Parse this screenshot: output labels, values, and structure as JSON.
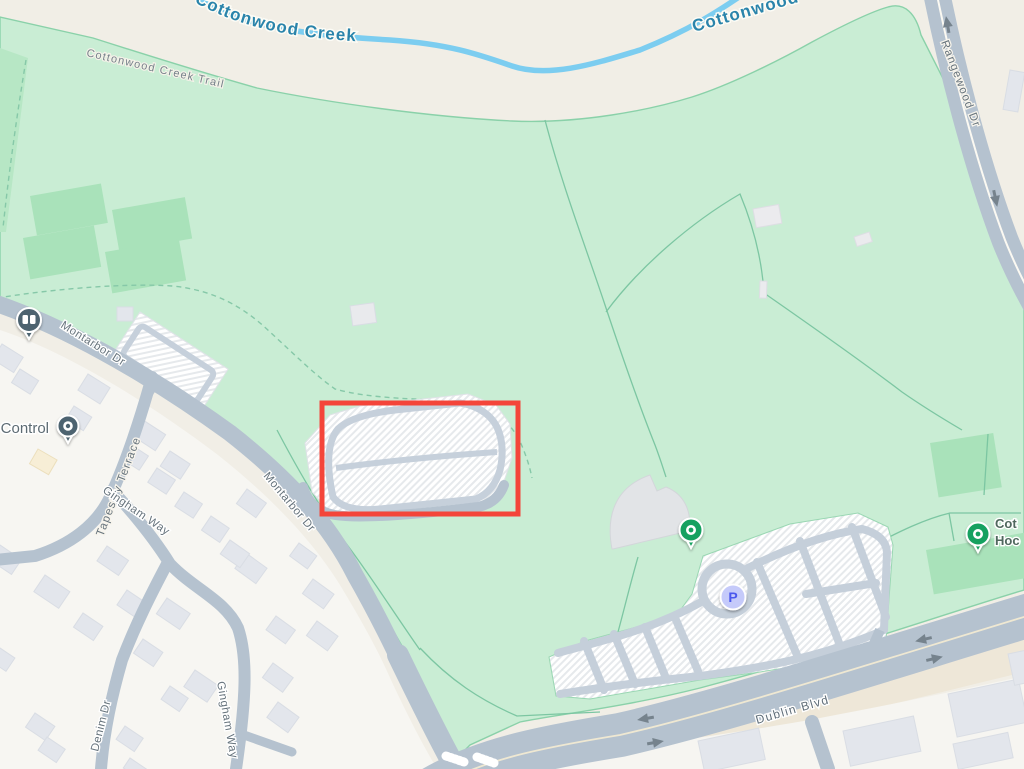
{
  "map": {
    "water_labels": {
      "creek": "Cottonwood Creek",
      "creek_partial": "Cottonwood"
    },
    "street_labels": {
      "trail": "Cottonwood Creek Trail",
      "rangewood": "Rangewood Dr",
      "montarbor_upper": "Montarbor Dr",
      "montarbor_lower": "Montarbor Dr",
      "tapestry": "Tapestry Terrace",
      "gingham_upper": "Gingham Way",
      "gingham_lower": "Gingham Way",
      "denim": "Denim Dr",
      "dublin": "Dublin Blvd"
    },
    "pois": {
      "control": {
        "label": "Control",
        "icon": "dot-pin"
      },
      "library": {
        "icon": "open-book-pin"
      },
      "park_west": {
        "icon": "dot-pin"
      },
      "park_east": {
        "icon": "dot-pin",
        "label_line1": "Cot",
        "label_line2": "Hoc"
      },
      "parking": {
        "badge": "P"
      }
    },
    "annotation": {
      "shape": "rectangle",
      "color": "#f4453a",
      "x": 322,
      "y": 403,
      "width": 196,
      "height": 111
    },
    "colors": {
      "land": "#f1eee6",
      "park": "#c9edd4",
      "sports_field": "#a9e2ba",
      "water": "#7ccdf0",
      "road": "#b5c2cf",
      "residential": "#f7f6f2",
      "building": "#e3e6ec",
      "pin_slate": "#4d6470",
      "pin_green": "#18a160",
      "parking_badge_bg": "#c5cafa",
      "parking_badge_text": "#4b59ee",
      "annotation_red": "#f4453a"
    }
  }
}
